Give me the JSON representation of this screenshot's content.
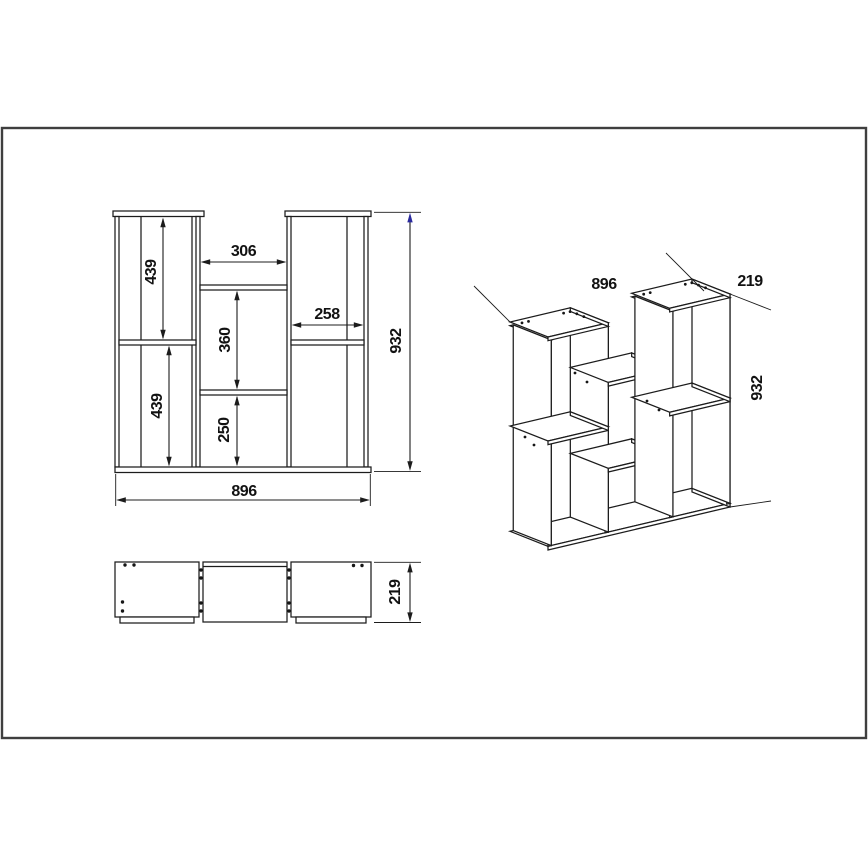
{
  "title": "Shelving unit technical drawing",
  "front_view": {
    "dim_upper_left_height": "439",
    "dim_lower_left_height": "439",
    "dim_middle_opening_width": "306",
    "dim_right_opening_width": "258",
    "dim_middle_upper_gap": "360",
    "dim_middle_lower_gap": "250",
    "dim_total_height": "932",
    "dim_total_width": "896"
  },
  "top_view": {
    "dim_depth": "219"
  },
  "iso_view": {
    "dim_width": "896",
    "dim_depth": "219",
    "dim_height": "932"
  },
  "colors": {
    "line": "#1c1c1c",
    "frame_border": "#3f3f3f",
    "blue_arrow": "#2a2a9e"
  }
}
